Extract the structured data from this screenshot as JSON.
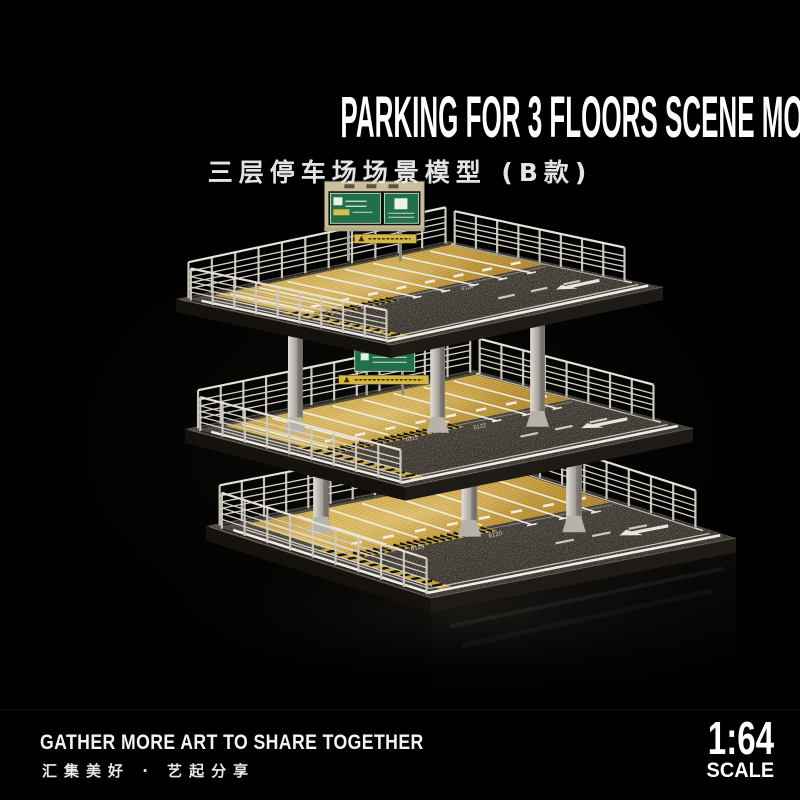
{
  "title": "PARKING FOR 3 FLOORS SCENE MODEL  (SECTION B)",
  "subtitle_cn": "三层停车场场景模型 (B款)",
  "footer": {
    "slogan_en": "GATHER MORE ART TO SHARE TOGETHER",
    "slogan_cn": "汇集美好 · 艺起分享"
  },
  "scale_badge": {
    "ratio": "1:64",
    "label": "SCALE"
  },
  "scene": {
    "floors": 3,
    "stall_numbers": [
      "6120",
      "6111",
      "6122",
      "6129"
    ],
    "colors": {
      "background": "#000000",
      "asphalt": "#3e3933",
      "wood": "#d3ab4e",
      "railing": "#d6d2c8",
      "sign_green": "#20704a",
      "sign_board": "#c9c09b",
      "hazard_yellow": "#c9a53b",
      "road_line": "#f0ede5",
      "pillar": "#b5b1a9"
    }
  }
}
